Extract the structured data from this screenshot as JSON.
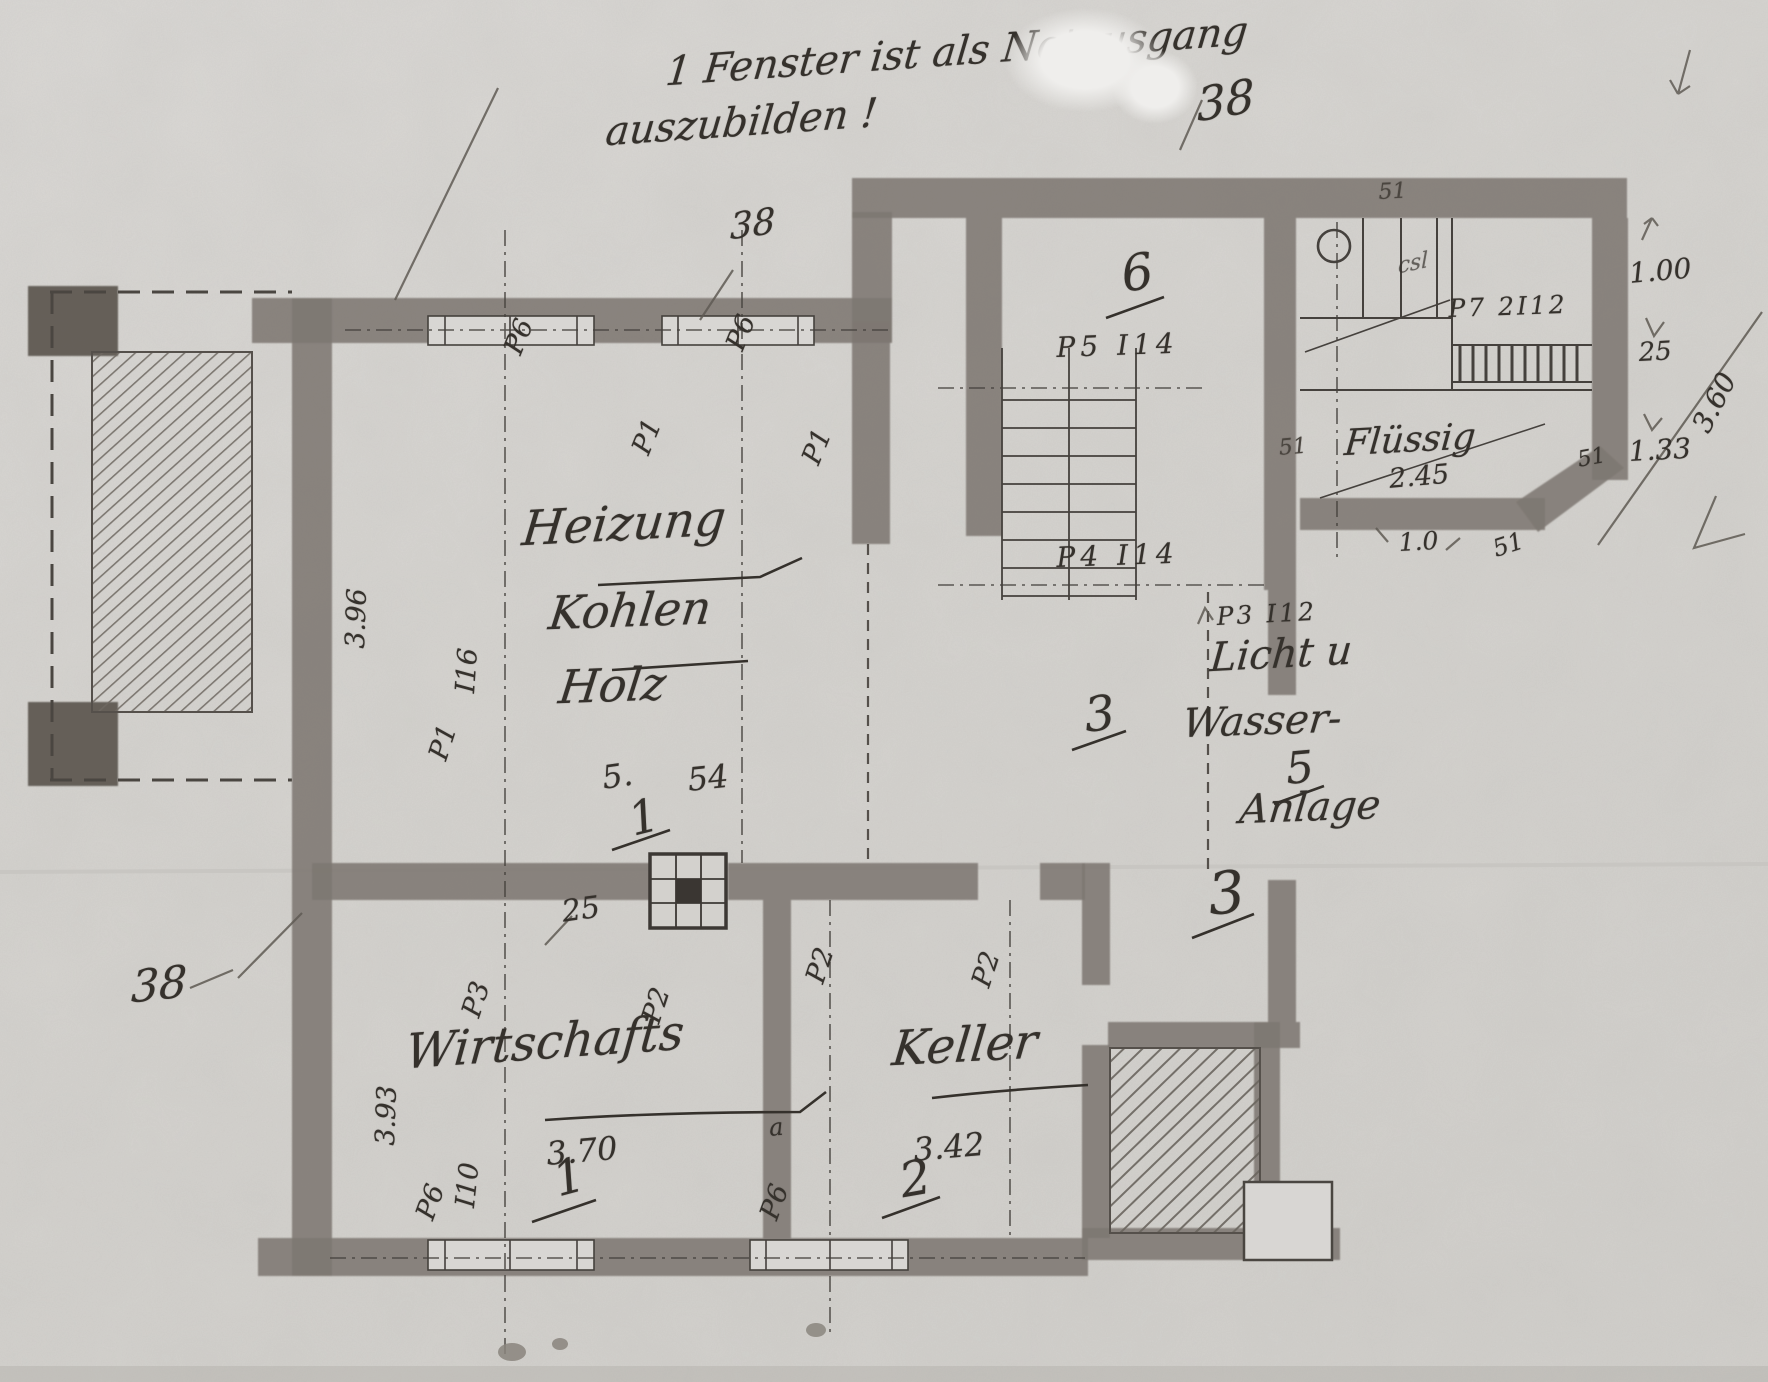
{
  "note": {
    "line1": "1 Fenster ist als Notausgang",
    "line2": "auszubilden !"
  },
  "marks": {
    "dim38_top_right": "38",
    "dim38_wall": "38",
    "dim38_bottom_left": "38"
  },
  "rooms": {
    "heizung": {
      "name1": "Heizung",
      "name2": "Kohlen",
      "name3": "Holz",
      "width_a": "5.",
      "width_b": "54",
      "number": "1",
      "height_dim": "3.96"
    },
    "wirtschafts": {
      "name": "Wirtschafts",
      "width_dim": "3.70",
      "number": "1",
      "height_dim": "3.93",
      "wall_offset": "25",
      "small_mark": "a"
    },
    "keller": {
      "name": "Keller",
      "width_dim": "3.42",
      "number": "2"
    },
    "stair_hall": {
      "number": "6",
      "post_upper": "P5 I14",
      "post_lower": "P4 I14"
    },
    "corridor": {
      "number_upper": "3",
      "number_lower": "3",
      "post": "P3 I12"
    },
    "licht_wasser": {
      "name1": "Licht u",
      "name2": "Wasser-",
      "name3": "Anlage",
      "number": "5"
    },
    "fluessig": {
      "name": "Flüssig",
      "dim": "2.45",
      "post": "P7 2I12",
      "scribble": "csl"
    }
  },
  "posts": {
    "top_left": "P6",
    "top_right": "P6",
    "mid_left": "P1",
    "mid_right": "P1",
    "wall_left_a": "P1",
    "wall_left_b": "I16",
    "row2_a": "P3",
    "row2_b": "P2",
    "row2_c": "P2",
    "row2_d": "P2",
    "bottom_a": "P6",
    "bottom_a2": "I10",
    "bottom_b": "P6"
  },
  "wall_thickness": {
    "top": "51",
    "left": "51",
    "right": "51",
    "bottom": "51"
  },
  "dims_right": {
    "d1": "1.00",
    "d2": "25",
    "d3": "1.33",
    "diag": "3.60",
    "annex": "1.0"
  }
}
